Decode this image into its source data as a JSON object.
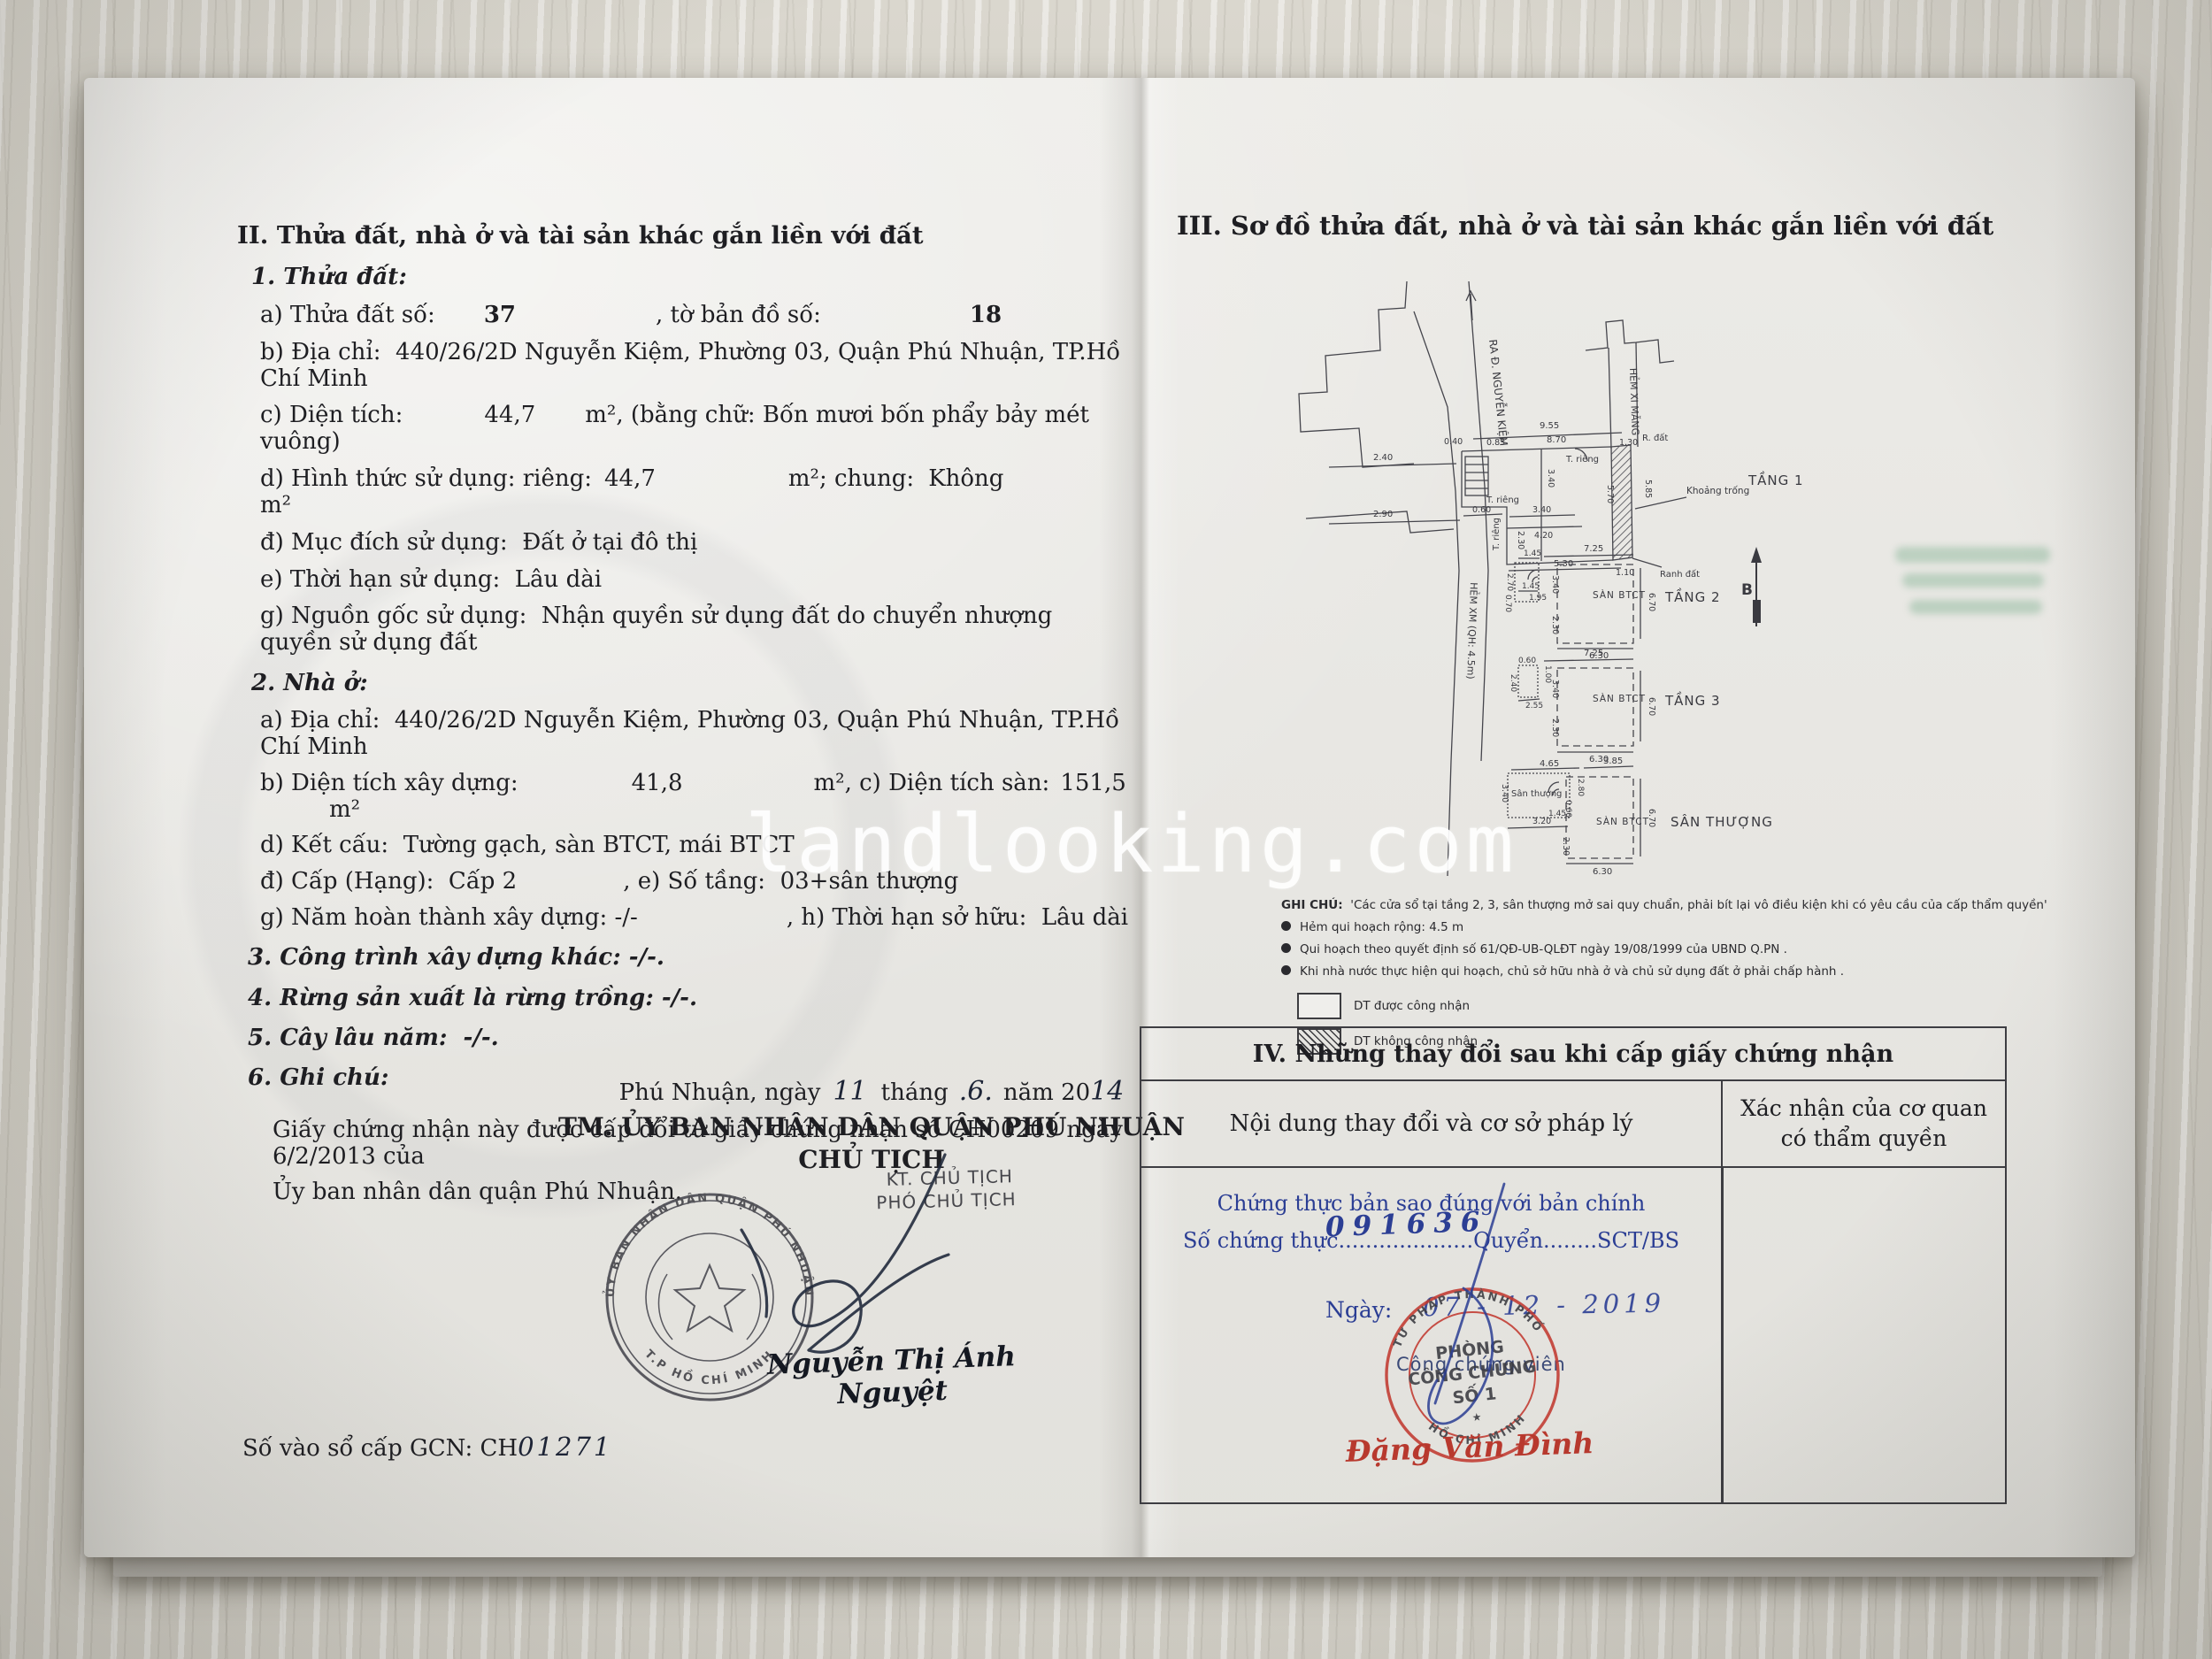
{
  "watermark": "landlooking.com",
  "left": {
    "title": "II. Thửa đất, nhà ở và tài sản khác gắn liền với đất",
    "p1": {
      "h": "1. Thửa đất:",
      "a1": "a) Thửa đất số:",
      "a2": "37",
      "a3": ", tờ bản đồ số:",
      "a4": "18",
      "b": "b) Địa chỉ:  440/26/2D Nguyễn Kiệm, Phường 03, Quận Phú Nhuận, TP.Hồ Chí Minh",
      "c1": "c) Diện tích:",
      "c2": "44,7",
      "c3": "m², (bằng chữ: Bốn mươi bốn phẩy bảy mét vuông)",
      "d1": "d) Hình thức sử dụng: riêng:",
      "d2": "44,7",
      "d3": "m²; chung:",
      "d4": "Không",
      "d5": "m²",
      "e1": "đ) Mục đích sử dụng:  Đất ở tại đô thị",
      "e2": "e) Thời hạn sử dụng:  Lâu dài",
      "g": "g) Nguồn gốc sử dụng:  Nhận quyền sử dụng đất do chuyển nhượng quyền sử dụng đất"
    },
    "p2": {
      "h": "2. Nhà ở:",
      "a": "a) Địa chỉ:  440/26/2D Nguyễn Kiệm, Phường 03, Quận Phú Nhuận, TP.Hồ Chí Minh",
      "b1": "b) Diện tích xây dựng:",
      "b2": "41,8",
      "b3": "m², c) Diện tích sàn:",
      "b4": "151,5",
      "b5": "m²",
      "d": "d) Kết cấu:  Tường gạch, sàn BTCT, mái BTCT",
      "dd1": "đ) Cấp (Hạng):  Cấp 2",
      "dd2": ", e) Số tầng:  03+sân thượng",
      "g1": "g) Năm hoàn thành xây dựng: -/-",
      "g2": ", h) Thời hạn sở hữu:  Lâu dài"
    },
    "p3": "3. Công trình xây dựng khác: -/-.",
    "p4": "4. Rừng sản xuất là rừng trồng: -/-.",
    "p5": "5. Cây lâu năm:  -/-.",
    "p6": "6. Ghi chú:",
    "note1": "Giấy chứng nhận này được cấp đổi từ giấy chứng nhận số CH00209 ngày 6/2/2013 của",
    "note2": "Ủy ban nhân dân quận Phú Nhuận.",
    "sign": {
      "pl1": "Phú Nhuận, ngày",
      "day": "11",
      "pl2": "tháng",
      "mon": ".6.",
      "pl3": "năm 20",
      "yr": "14",
      "committee": "TM. ỦY BAN NHÂN DÂN QUẬN PHÚ NHUẬN",
      "chairman": "CHỦ TỊCH",
      "kt": "KT. CHỦ TỊCH",
      "deputy": "PHÓ CHỦ TỊCH",
      "name": "Nguyễn Thị Ánh Nguyệt",
      "seal_top": "ỦY BAN NHÂN DÂN QUẬN PHÚ NHUẬN",
      "seal_bottom": "T.P HỒ CHÍ MINH"
    },
    "book1": "Số vào sổ cấp GCN: CH",
    "book2": "01271"
  },
  "right": {
    "title": "III. Sơ đồ thửa đất, nhà ở và tài sản khác gắn liền với đất",
    "diagram": {
      "street": "RA Đ. NGUYỄN KIỆM",
      "alley": "HẺM XI MĂNG",
      "alley2": "HẺM XM (QH: 4.5m)",
      "f1": "TẦNG 1",
      "f2": "TẦNG 2",
      "f3": "TẦNG 3",
      "roof": "SÂN THƯỢNG",
      "slab": "SÀN BTCT",
      "roof_sm": "Sân thượng",
      "void": "Khoảng trống",
      "rdat": "R. đất",
      "ranh": "Ranh đất",
      "trieng": "T. riêng",
      "north": "B",
      "t1": [
        "9.55",
        "0.40",
        "0.85",
        "8.70",
        "1.30",
        "2.40",
        "2.90",
        "3.40",
        "0.60",
        "3.40",
        "4.20",
        "2.30",
        "5.30",
        "1.10",
        "5.70",
        "5.85"
      ],
      "t2": [
        "1.45",
        "7.25",
        "2.70",
        "1.45",
        "0.70",
        "1.95",
        "3.40",
        "2.30",
        "6.70",
        "6.30"
      ],
      "t3": [
        "7.25",
        "0.60",
        "1.00",
        "2.40",
        "2.55",
        "3.40",
        "2.30",
        "6.70",
        "6.30"
      ],
      "st": [
        "4.65",
        "3.85",
        "3.40",
        "2.80",
        "0.60",
        "1.45",
        "3.20",
        "2.30",
        "6.70",
        "6.30"
      ]
    },
    "notes": {
      "t": "GHI CHÚ:",
      "q": "'Các cửa sổ tại tầng 2, 3, sân thượng mở sai quy chuẩn, phải bít lại vô điều kiện khi có yêu cầu của cấp thẩm quyền'",
      "b1": "Hẻm qui hoạch rộng: 4.5 m",
      "b2": "Qui hoạch theo quyết định số 61/QĐ-UB-QLĐT ngày 19/08/1999 của UBND Q.PN .",
      "b3": "Khi nhà nước thực hiện qui hoạch, chủ sở hữu nhà ở và chủ sử dụng đất ở phải chấp hành .",
      "l1": "DT được công nhận",
      "l2": "DT không công nhận"
    },
    "table": {
      "title": "IV. Những thay đổi sau khi cấp giấy chứng nhận",
      "c1": "Nội dung thay đổi và cơ sở pháp lý",
      "c2": "Xác nhận của cơ quan",
      "c2b": "có thẩm quyền",
      "b1": "Chứng thực bản sao đúng với bản chính",
      "b2a": "Số chứng thực",
      "b2dots": "....................",
      "b2hw": "091636",
      "b2b": "Quyển........SCT/BS",
      "b3a": "Ngày:",
      "b3hw": "07 - 12 - 2019",
      "notary": "Công chứng viên",
      "s1": "PHÒNG",
      "s2": "CÔNG CHỨNG",
      "s3": "SỐ 1",
      "ring_top": "TƯ PHÁP THÀNH PHỐ",
      "ring_bottom": "HỒ CHÍ MINH",
      "name": "Đặng Văn Đình"
    }
  }
}
